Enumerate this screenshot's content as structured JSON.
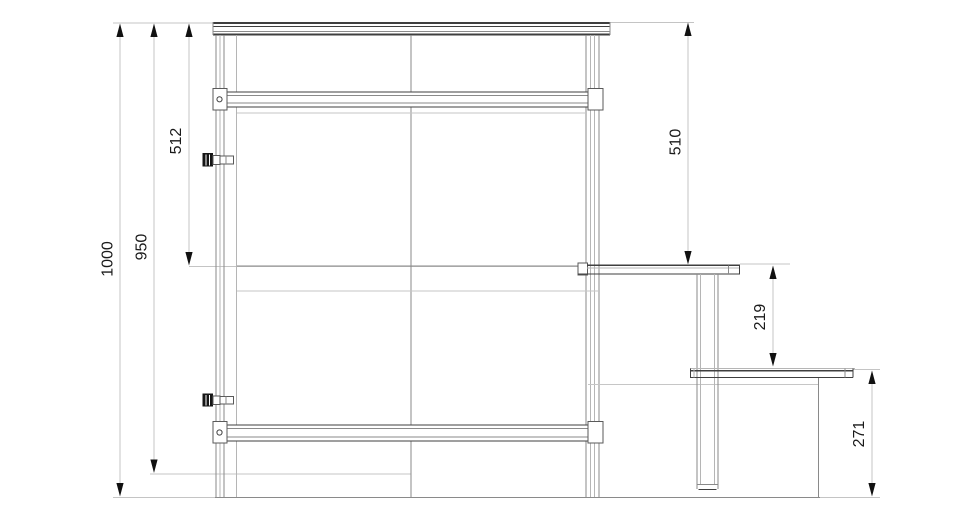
{
  "drawing": {
    "type": "technical-elevation",
    "subject": "workbench-with-step-ladder-side-view",
    "units": "mm",
    "dimensions": {
      "overall_height": "1000",
      "frame_height": "950",
      "upper_section_left": "512",
      "upper_section_right": "510",
      "step_offset": "219",
      "lower_step_height": "271"
    },
    "icons": {
      "fastener": "socket-head-screw-icon",
      "bracket_hole": "bolt-hole-icon"
    },
    "colors": {
      "background": "#ffffff",
      "structure_line": "#3f3f3f",
      "medium_line": "#8a8a8a",
      "light_line": "#c6c6c6",
      "dim_line": "#c4c4c4",
      "arrow": "#111111",
      "dimension_text": "#1a1a1a"
    }
  }
}
